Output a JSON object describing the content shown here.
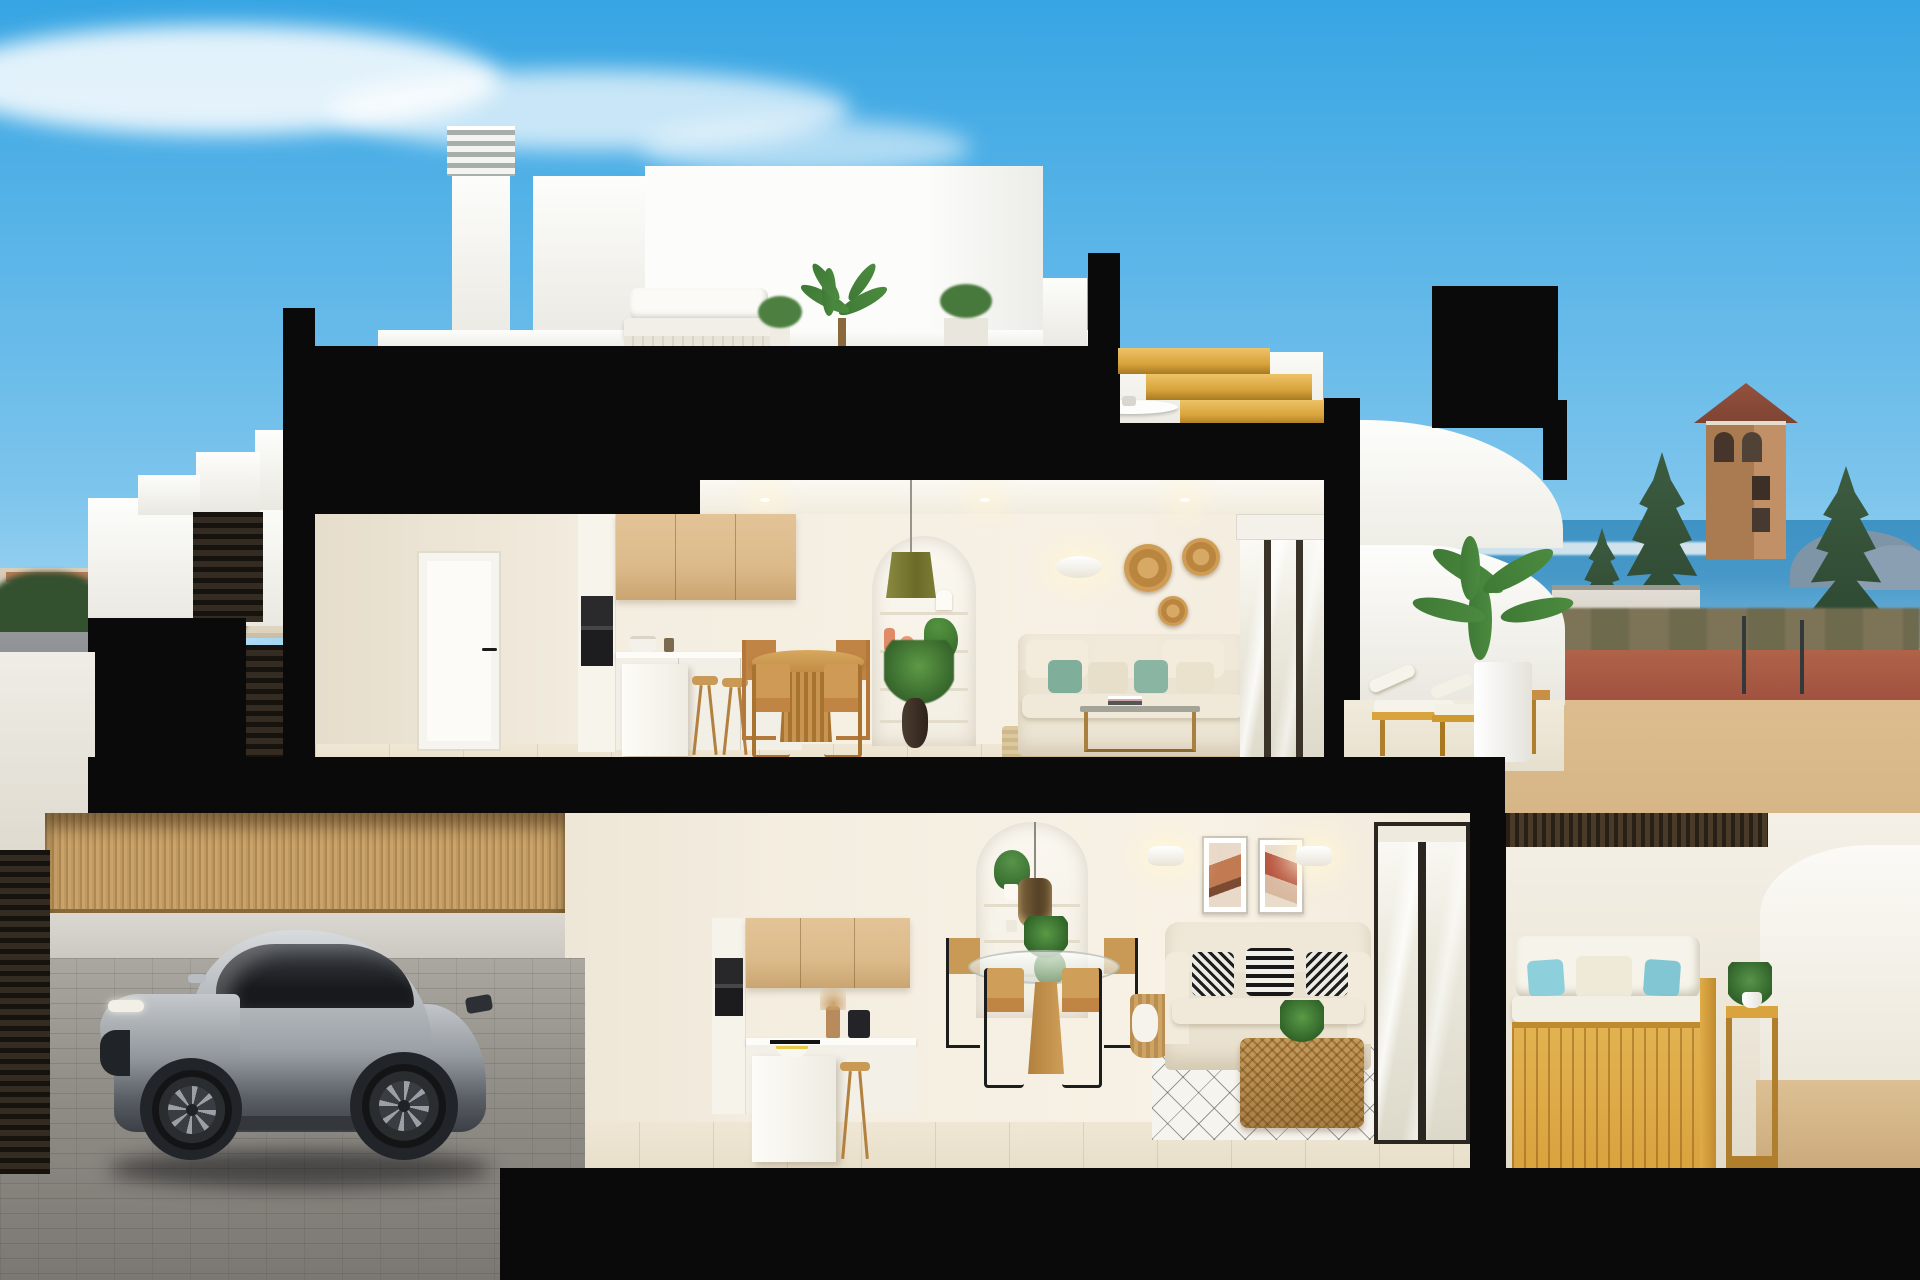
{
  "image": {
    "kind": "3d-architectural-cross-section-render",
    "description": "Cutaway rendering of a two-storey white Mediterranean townhouse showing furnished interiors on both floors, a rooftop terrace with chimneys, a silver sports car parked on the driveway, and a coastal town with sea, watchtower and cypress trees in the background",
    "width_px": 1920,
    "height_px": 1280
  },
  "scene": {
    "sky": [
      "blue gradient sky",
      "wispy white cloud top-left",
      "faint clouds near left horizon"
    ],
    "background_left": [
      "town skyline",
      "dark green trees",
      "grey road with zebra crossing",
      "red-brick pavement",
      "round blue traffic sign"
    ],
    "background_right": [
      "sea with distant skyline",
      "blue-grey mountains",
      "brick watchtower with tiled hip roof",
      "three dark cypress trees",
      "low white buildings",
      "red-brown road with lamp posts",
      "tan paving"
    ],
    "roof_level": [
      "two white chimneys with louvered caps",
      "white roof volumes",
      "rooftop lounge sofa with white cushions",
      "potted plants and small palm",
      "white ceiling fan under overhang",
      "golden wood staircase profile",
      "white curved parapet"
    ],
    "upper_floor": [
      "white hallway door with black handle",
      "kitchen with light-wood upper cabinets and black built-in oven",
      "white island with two wooden bar stools",
      "round wooden dining table with four wooden chairs",
      "arched wall niche with shelves, coral vases and plants",
      "olive-green pendant lamp",
      "white oval wall sconce",
      "three rattan wall baskets",
      "cream sofa with teal and cream cushions",
      "glass coffee table",
      "striped jute rug",
      "sliding glass door with roller blind",
      "terrace with two wooden sun loungers",
      "tall palm plant in white pot",
      "white curved parapet"
    ],
    "ground_floor": [
      "kitchen with wood upper cabinets, black oven, hob and coffee machine",
      "white island with fruit bowl and wooden stool",
      "arched niche with shelves, plants and woven pendant lamp",
      "round glass dining table with four chairs",
      "two framed abstract artworks",
      "two white wall sconces",
      "cream loveseat with three black-and-white patterned cushions",
      "wicker basket with throw",
      "rattan basket-weave coffee table with plant",
      "white rug with dark diamond grid",
      "dark-framed sliding glass doors",
      "plant on wooden stand"
    ],
    "ground_terrace": [
      "dark wood slatted ceiling",
      "golden wood outdoor sofa with white cushions and light-blue pillows",
      "wooden side table with potted plant",
      "white walls",
      "tan paving"
    ],
    "street_level_left": [
      "black section slab",
      "dark louvered gate",
      "concrete exterior stairs",
      "reed bamboo fence",
      "dark slatted garage door",
      "grey brick driveway",
      "silver-grey sports coupe facing left"
    ]
  },
  "counts": {
    "floors_shown": 2,
    "chimneys": 2,
    "upper_dining_chairs": 4,
    "ground_dining_chairs": 4,
    "wall_baskets": 3,
    "patterned_cushions": 3,
    "cypress_trees": 3,
    "sun_loungers": 2,
    "framed_artworks": 2,
    "cars": 1
  },
  "palette": {
    "sky_top": "#37a5e3",
    "sky_bottom": "#c6e9f8",
    "cut_black": "#0a0a0a",
    "wall_warm": "#f4eee1",
    "wall_shade": "#e6ddcb",
    "wood_cabinet": "#dcba8a",
    "wood_furniture": "#c08445",
    "floor_tile": "#e8dfca",
    "sea": "#4798c8",
    "road_red": "#a05140",
    "paving_tan": "#d6b586",
    "car_silver": "#9aa0a6",
    "plant_green": "#4c8a3f",
    "teal_cushion": "#7fae9b",
    "terrace_wood": "#d9a33e",
    "reed_fence": "#c9a36a",
    "gold_stairs": "#d8a43c",
    "tower_brick": "#aa7a50",
    "conifer": "#2c4530",
    "blue_pillow": "#8ecfdc"
  }
}
